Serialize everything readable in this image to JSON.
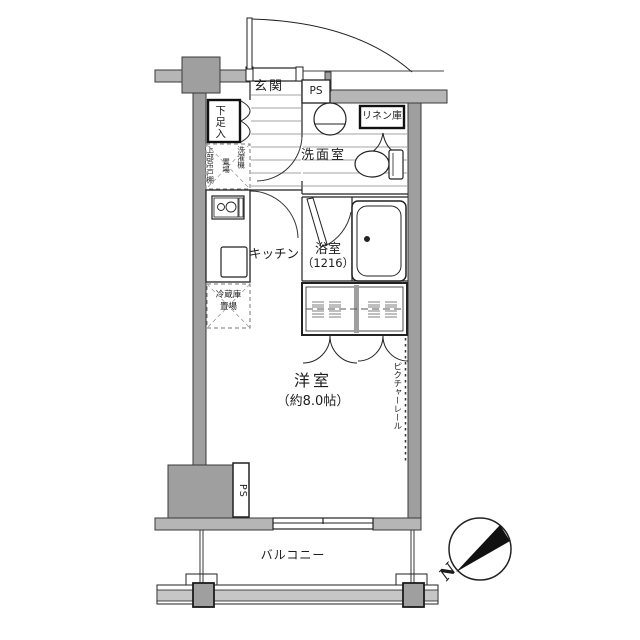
{
  "floorplan": {
    "rooms": {
      "genkan": "玄関",
      "washroom": "洗面室",
      "bathroom": "浴室",
      "bathroom_size": "（1216）",
      "kitchen": "キッチン",
      "main_room": "洋室",
      "main_room_size": "（約8.0帖）",
      "balcony": "バルコニー"
    },
    "storage": {
      "shoe_cabinet": "下足入",
      "linen_closet": "リネン庫",
      "upper_cabinet": "上部吊戸棚",
      "washer_place_line1": "洗濯機",
      "washer_place_line2": "置場",
      "fridge_place_line1": "冷蔵庫",
      "fridge_place_line2": "置場",
      "picture_rail": "ピクチャーレール"
    },
    "pipe_space_top": "PS",
    "pipe_space_bottom": "PS",
    "compass_north": "N",
    "colors": {
      "wall_fill": "#9f9f9f",
      "band_fill": "#b6b6b6",
      "outline": "#3a3a3a",
      "thin_line": "#222222",
      "hatch_line": "#858585",
      "railing_fill": "#c6c6c6",
      "needle_fill": "#111111"
    }
  }
}
